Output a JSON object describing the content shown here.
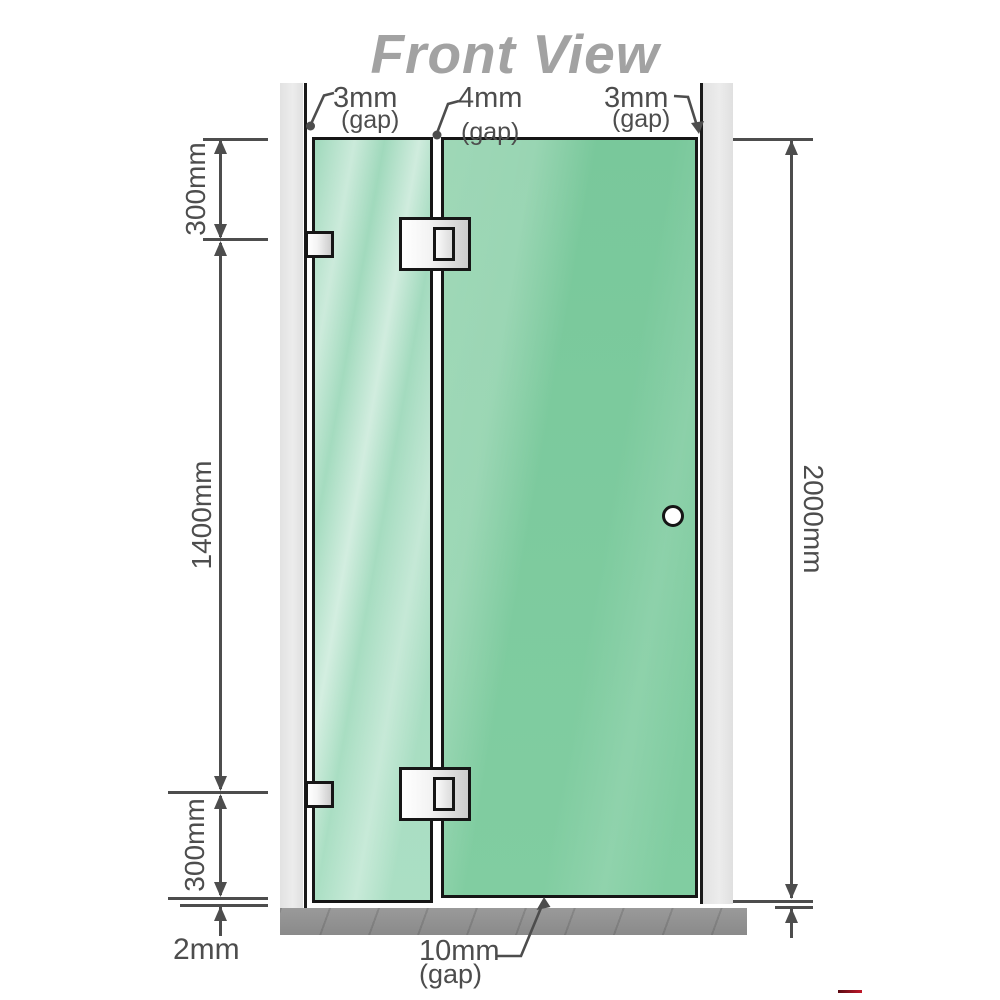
{
  "title": "Front View",
  "annotations": {
    "top_gaps": [
      {
        "value": "3mm",
        "note": "(gap)"
      },
      {
        "value": "4mm",
        "note": "(gap)"
      },
      {
        "value": "3mm",
        "note": "(gap)"
      }
    ],
    "left_dimensions": {
      "top": "300mm",
      "middle": "1400mm",
      "bottom": "300mm",
      "floor_gap": "2mm"
    },
    "right_dimension": "2000mm",
    "bottom_gap": {
      "value": "10mm",
      "note": "(gap)"
    }
  },
  "colors": {
    "glass_door": "#7ecb9f",
    "glass_fixed": "#abdfc4",
    "wall": "#e8e8e8",
    "floor": "#919191",
    "outline": "#161616",
    "dimension_lines": "#4d4d4d",
    "title_text": "#a2a2a2",
    "hardware": "#e6e6e6",
    "handle": "#ffffff"
  }
}
